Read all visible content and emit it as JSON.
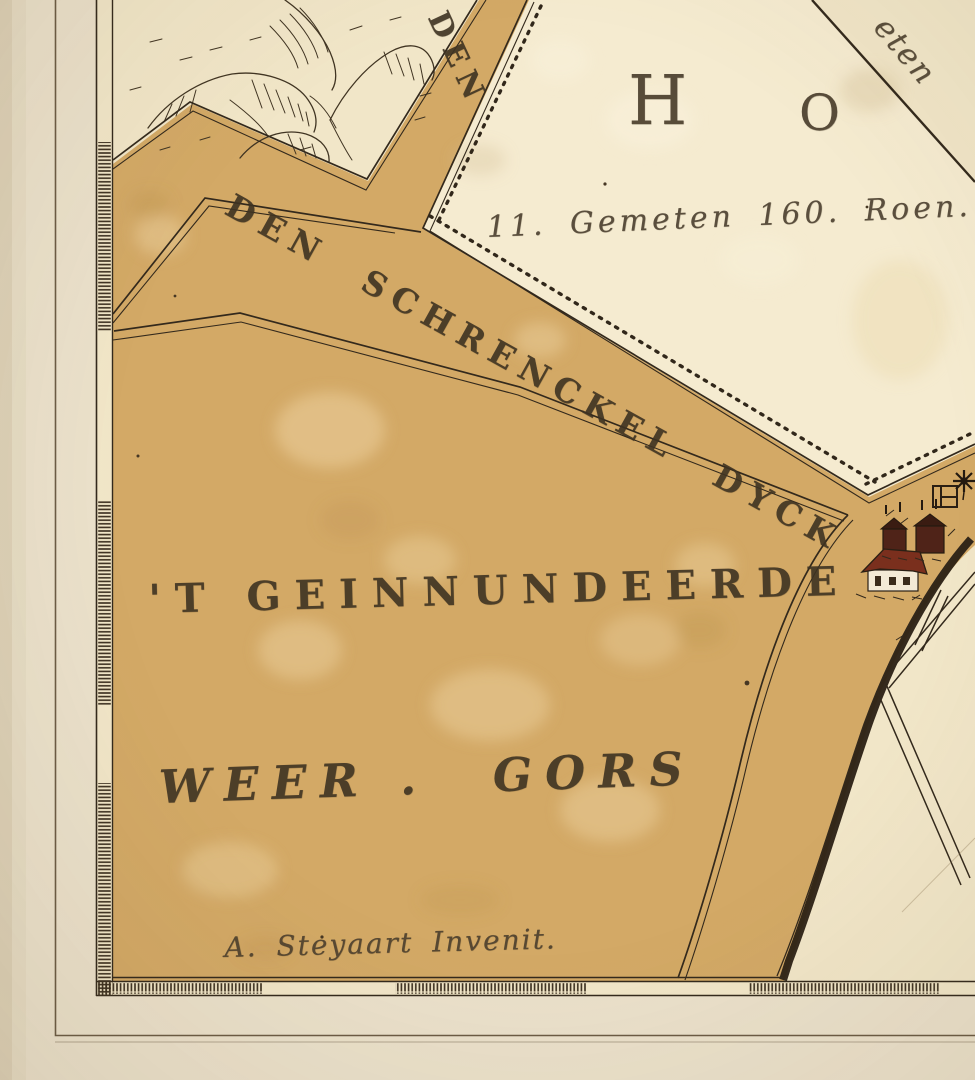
{
  "map": {
    "labels": {
      "dyke_road": "DEN SCHRENCKEL DYCK",
      "dyke_top_fragment": "DEN",
      "parcel_letter_h": "H",
      "parcel_letter_o": "O",
      "parcel_area_note": "11. Gemeten 160. Roen.",
      "corner_script_fragment": "eten",
      "polder_name_line1": "'T GEINNUNDEERDE",
      "polder_name_line2_left": "WEER .",
      "polder_name_line2_right": "GORS",
      "signature": "A. Steyaart Invenit."
    },
    "icons": {
      "farmhouse": "house with red roof",
      "barns": "two dark farm barns",
      "windmill": "eight-point windmill star",
      "farmstead_plan": "small square plan outline",
      "dunes": "engraved dune hills"
    },
    "palette": {
      "paper_margin": "#ebe1cb",
      "parchment": "#f1e6c8",
      "parcel_light": "#f5ebd0",
      "polder_tan": "#d3a966",
      "ink": "#33291c",
      "roof_red": "#7a2f1d",
      "barn_brown": "#4f2318"
    }
  }
}
